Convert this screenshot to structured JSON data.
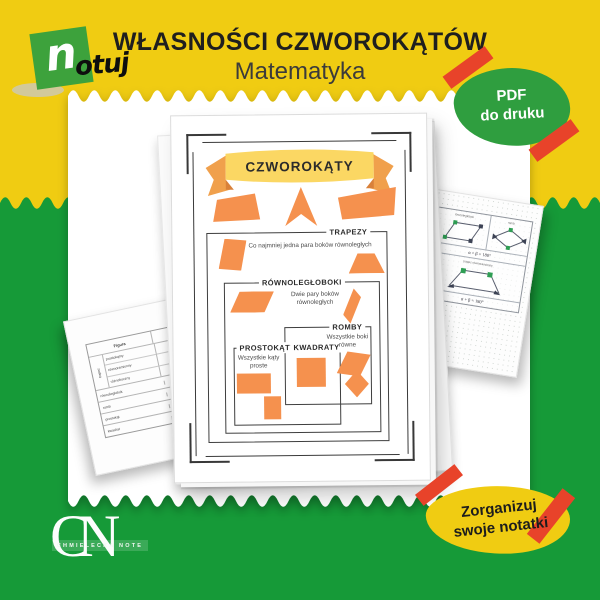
{
  "colors": {
    "yellow": "#F0CC12",
    "green": "#169A38",
    "logo-green": "#3DA23C",
    "badge-green": "#2F9E3F",
    "tape-red": "#E8432A",
    "orange": "#F5914E",
    "ribbon-orange": "#F0A04C",
    "ribbon-yellow": "#FBD763",
    "title-ink": "#1F1F1F"
  },
  "header": {
    "title": "WŁASNOŚCI CZWOROKĄTÓW",
    "subtitle": "Matematyka"
  },
  "logo": {
    "n": "n",
    "otuj": "otuj"
  },
  "pdf_badge": {
    "line1": "PDF",
    "line2": "do druku"
  },
  "organize_badge": {
    "line1": "Zorganizuj",
    "line2": "swoje notatki"
  },
  "cn_logo": {
    "initials_c": "C",
    "initials_n": "N",
    "name": "CHMIELECKA NOTE"
  },
  "worksheet": {
    "banner": "CZWOROKĄTY",
    "trapezy_label": "TRAPEZY",
    "trapezy_desc": "Co najmniej jedna para boków równoległych",
    "rownolegloboki_label": "RÓWNOLEGŁOBOKI",
    "rownolegloboki_desc": "Dwie pary boków równoległych",
    "romby_label": "ROMBY",
    "romby_desc": "Wszystkie boki równe",
    "prostokaty_label": "PROSTOKĄTY",
    "prostokaty_desc": "Wszystkie kąty proste",
    "kwadraty_label": "KWADRATY"
  },
  "left_paper": {
    "header": "Figura",
    "group_label": "trapez",
    "group_rows": [
      "prostokątny",
      "równoramienny",
      "różnoboczny"
    ],
    "rows": [
      "równoległobok",
      "romb",
      "prostokąt",
      "kwadrat"
    ]
  },
  "right_paper": {
    "cell1_label": "równoległobok",
    "cell2_label": "romb",
    "formula1": "α + β = 180°",
    "cell3_label": "trapez równoramienny",
    "formula2": "α + β = 180°"
  }
}
